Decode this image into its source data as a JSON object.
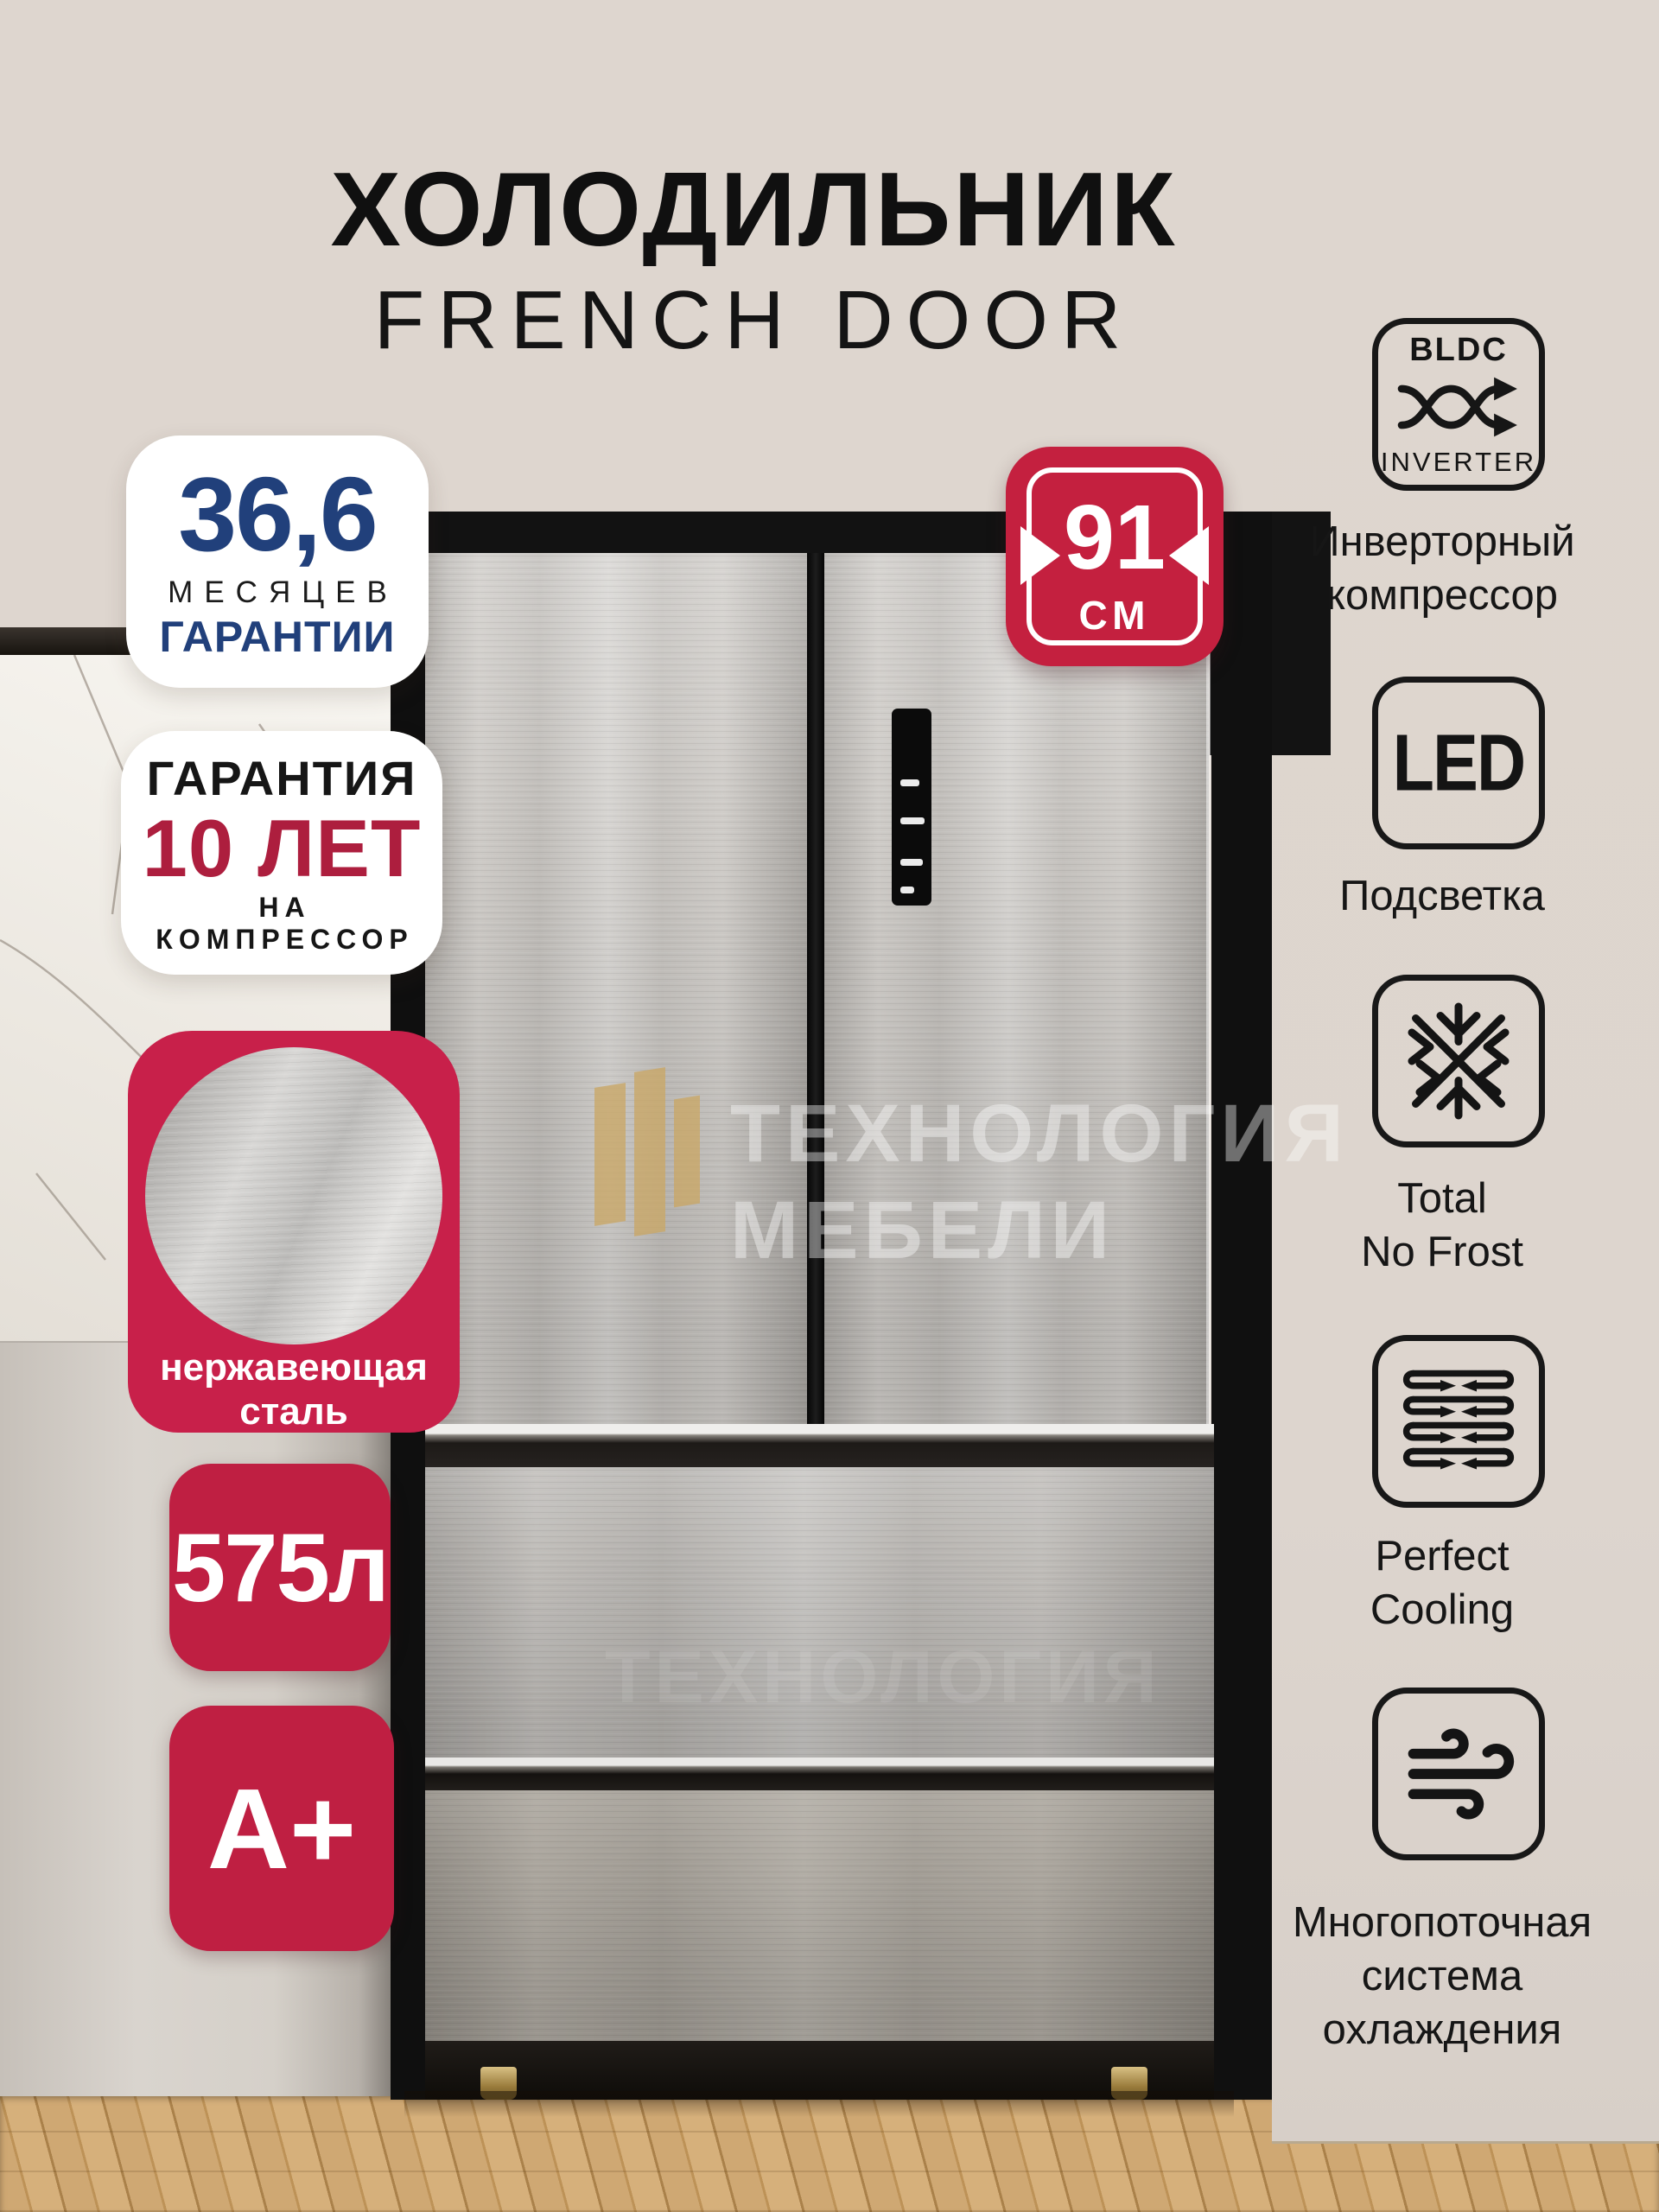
{
  "page": {
    "background": "#ded6cf",
    "accent_red": "#c4203f",
    "navy_blue": "#21407b",
    "dark_red": "#ad1e3e",
    "gold": "#c9a768"
  },
  "header": {
    "title": "ХОЛОДИЛЬНИК",
    "subtitle": "FRENCH DOOR"
  },
  "badges": {
    "warranty_months": {
      "value": "36,6",
      "unit": "МЕСЯЦЕВ",
      "label": "ГАРАНТИИ"
    },
    "compressor_warranty": {
      "title": "ГАРАНТИЯ",
      "value": "10 ЛЕТ",
      "label": "НА КОМПРЕССОР"
    },
    "material": {
      "line1": "нержавеющая",
      "line2": "сталь"
    },
    "volume": {
      "value": "575л"
    },
    "energy_class": {
      "value": "A+"
    },
    "width": {
      "value": "91",
      "unit": "СМ"
    }
  },
  "features": [
    {
      "icon": "bldc-inverter-icon",
      "icon_top": "BLDC",
      "icon_bottom": "INVERTER",
      "lines": [
        "Инверторный",
        "компрессор"
      ]
    },
    {
      "icon": "led-icon",
      "icon_text": "LED",
      "lines": [
        "Подсветка"
      ]
    },
    {
      "icon": "snowflake-icon",
      "lines": [
        "Total",
        "No Frost"
      ]
    },
    {
      "icon": "air-circulation-icon",
      "lines": [
        "Perfect",
        "Cooling"
      ]
    },
    {
      "icon": "wind-icon",
      "lines": [
        "Многопоточная",
        "система",
        "охлаждения"
      ]
    }
  ],
  "watermark": {
    "line1": "ТЕХНОЛОГИЯ",
    "line2": "МЕБЕЛИ"
  }
}
